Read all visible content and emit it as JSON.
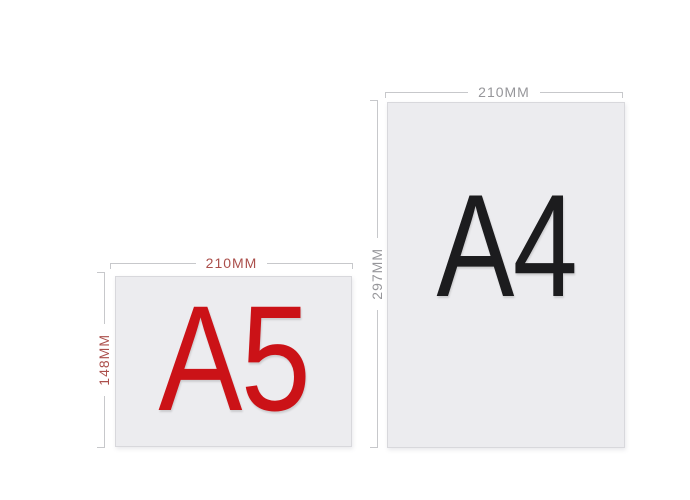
{
  "colors": {
    "background": "#ffffff",
    "paper_fill": "#ececef",
    "paper_border": "#d8d8dc",
    "dimension_line": "#c7c8cb",
    "a5_accent": "#cb1217",
    "a5_dimension_text": "#ab4f4b",
    "a4_text": "#1c1c1e",
    "a4_dimension_text": "#96969a"
  },
  "papers": [
    {
      "size_label": "A5",
      "orientation": "landscape",
      "width_label": "210MM",
      "height_label": "148MM"
    },
    {
      "size_label": "A4",
      "orientation": "portrait",
      "width_label": "210MM",
      "height_label": "297MM"
    }
  ]
}
